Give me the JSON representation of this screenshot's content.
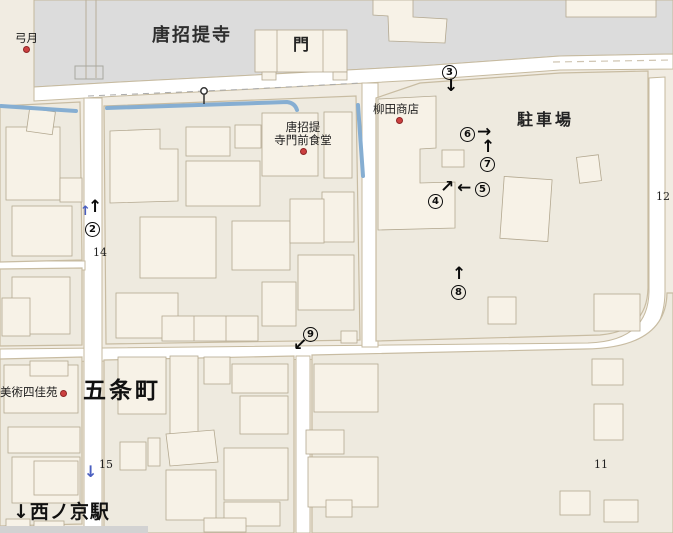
{
  "map_labels": {
    "temple": "唐招提寺",
    "gate": "門",
    "yumizuki": "弓月",
    "yanagida_shop": "柳田商店",
    "restaurant_line1": "唐招提",
    "restaurant_line2": "寺門前食堂",
    "parking_lot": "駐車場",
    "gojo_cho": "五条町",
    "bijutsu_shikaen": "美術四佳苑",
    "station_arrow": "↓",
    "station": "西ノ京駅",
    "block_14": "14",
    "block_15": "15",
    "block_11": "11",
    "block_12": "12"
  },
  "markers": [
    {
      "num": "2",
      "arrow": "↑",
      "extra_blue_arrow": "↑"
    },
    {
      "num": "3",
      "arrow": "↓"
    },
    {
      "num": "4",
      "arrow": "↗"
    },
    {
      "num": "5",
      "arrow": "←"
    },
    {
      "num": "6",
      "arrow": "→"
    },
    {
      "num": "7",
      "arrow": "↑"
    },
    {
      "num": "8",
      "arrow": "↑"
    },
    {
      "num": "9",
      "arrow": "↙"
    }
  ],
  "route_arrows": {
    "south_blue": "↓"
  },
  "colors": {
    "background": "#f1ece2",
    "temple_grounds": "#dcdcdc",
    "block_fill": "#eeeadf",
    "building_fill": "#f7f2e7",
    "road_fill": "#ffffff",
    "road_casing": "#c6ba9f",
    "water": "#86aed2",
    "poi_dot": "#cc4040",
    "marker_ink": "#0b0b0b",
    "blue_arrow": "#4a5fc0"
  }
}
